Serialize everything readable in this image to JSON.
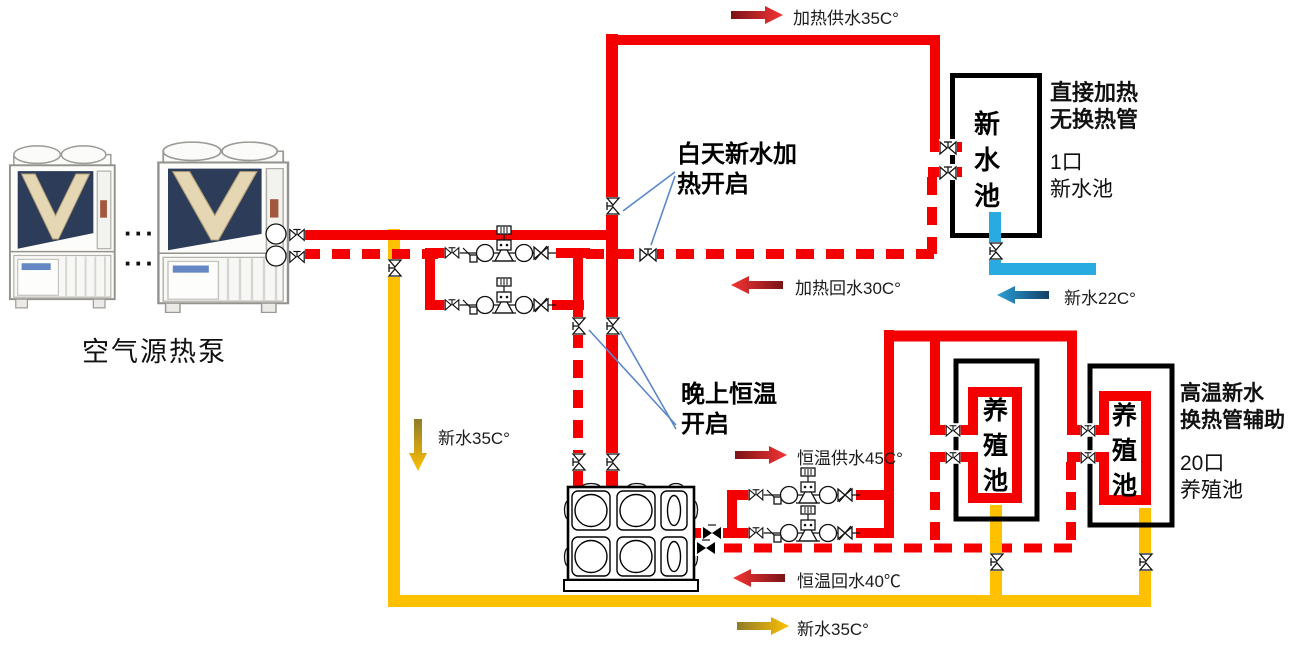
{
  "heat_pump": {
    "label": "空气源热泵",
    "ellipsis_top": "···",
    "ellipsis_bottom": "···"
  },
  "flow_labels": {
    "heating_supply": "加热供水35C°",
    "heating_return": "加热回水30C°",
    "constant_supply": "恒温供水45C°",
    "constant_return": "恒温回水40℃",
    "new_water_down": "新水35C°",
    "new_water_bottom": "新水35C°",
    "new_water_cold": "新水22C°"
  },
  "annotations": {
    "day_line1": "白天新水加",
    "day_line2": "热开启",
    "night_line1": "晚上恒温",
    "night_line2": "开启"
  },
  "new_pool": {
    "tank_label": "新水池",
    "note_line1": "直接加热",
    "note_line2": "无换热管",
    "count": "1口",
    "count_target": "新水池"
  },
  "breeding": {
    "pool1_label": "养殖池",
    "pool2_label": "养殖池",
    "note_line1": "高温新水",
    "note_line2": "换热管辅助",
    "count": "20口",
    "count_target": "养殖池"
  },
  "colors": {
    "hot_pipe": "#f40000",
    "new_water_pipe": "#ffc000",
    "cold_water_pipe": "#29abe2"
  }
}
